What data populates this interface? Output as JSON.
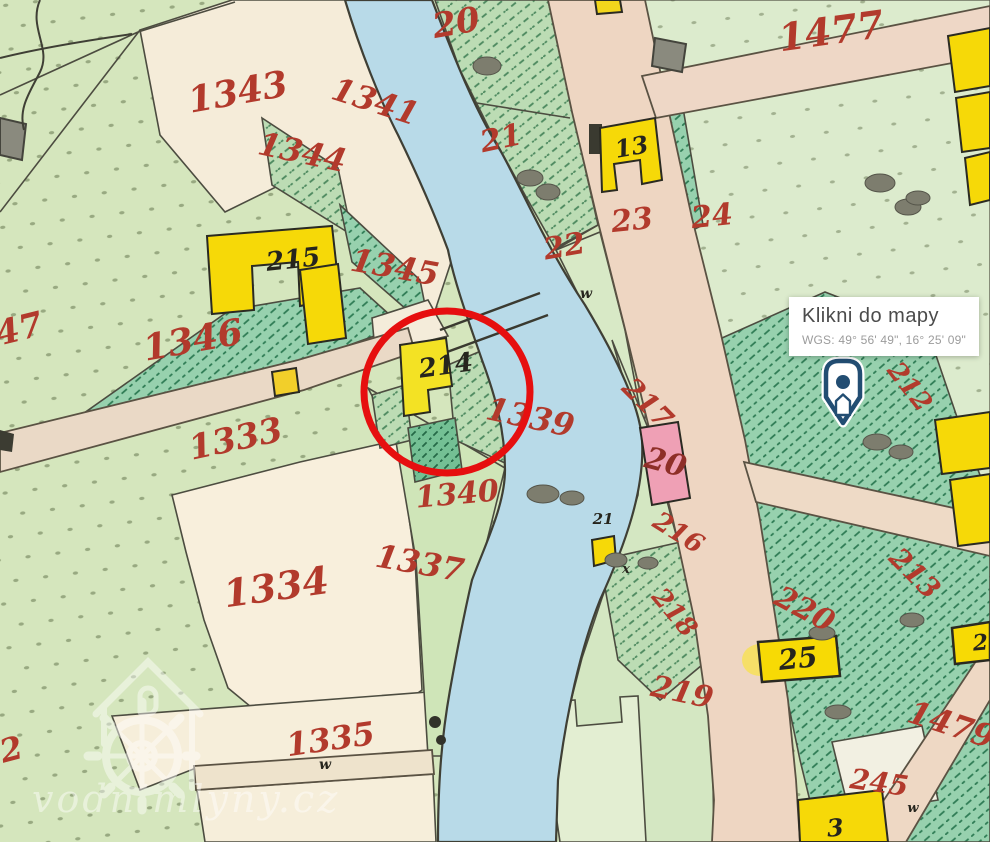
{
  "popup": {
    "title": "Klikni do mapy",
    "coords": "WGS: 49° 56' 49\", 16° 25' 09\""
  },
  "watermark": {
    "text": "vodnimlyny.cz"
  },
  "annotation": {
    "type": "highlight-circle",
    "color": "#e60f0f"
  },
  "colors": {
    "river": "#b8dae8",
    "road": "#eedac6",
    "building_yellow": "#f6d908",
    "building_pink": "#efa0b5",
    "parcel_label_red": "#b23a2c",
    "pin_navy": "#224d72"
  },
  "map": {
    "labels": [
      {
        "text": "20",
        "x": 458,
        "y": 34,
        "rot": -10,
        "size": 34,
        "color": "red"
      },
      {
        "text": "1477",
        "x": 833,
        "y": 44,
        "rot": -8,
        "size": 38,
        "color": "red"
      },
      {
        "text": "1343",
        "x": 240,
        "y": 104,
        "rot": -10,
        "size": 36,
        "color": "red"
      },
      {
        "text": "1341",
        "x": 372,
        "y": 112,
        "rot": 18,
        "size": 32,
        "color": "red"
      },
      {
        "text": "1344",
        "x": 300,
        "y": 163,
        "rot": 12,
        "size": 32,
        "color": "red"
      },
      {
        "text": "21",
        "x": 503,
        "y": 148,
        "rot": -12,
        "size": 30,
        "color": "red"
      },
      {
        "text": "23",
        "x": 633,
        "y": 230,
        "rot": -6,
        "size": 30,
        "color": "red"
      },
      {
        "text": "24",
        "x": 713,
        "y": 226,
        "rot": -6,
        "size": 30,
        "color": "red"
      },
      {
        "text": "22",
        "x": 566,
        "y": 256,
        "rot": -10,
        "size": 30,
        "color": "red"
      },
      {
        "text": "1345",
        "x": 393,
        "y": 278,
        "rot": 10,
        "size": 32,
        "color": "red"
      },
      {
        "text": "47",
        "x": 22,
        "y": 340,
        "rot": -14,
        "size": 34,
        "color": "red"
      },
      {
        "text": "1346",
        "x": 195,
        "y": 352,
        "rot": -10,
        "size": 36,
        "color": "red"
      },
      {
        "text": "1333",
        "x": 238,
        "y": 450,
        "rot": -12,
        "size": 34,
        "color": "red"
      },
      {
        "text": "1339",
        "x": 528,
        "y": 428,
        "rot": 12,
        "size": 32,
        "color": "red"
      },
      {
        "text": "217",
        "x": 641,
        "y": 410,
        "rot": 45,
        "size": 28,
        "color": "red"
      },
      {
        "text": "212",
        "x": 903,
        "y": 392,
        "rot": 52,
        "size": 26,
        "color": "red"
      },
      {
        "text": "20",
        "x": 663,
        "y": 472,
        "rot": 15,
        "size": 30,
        "color": "maroon"
      },
      {
        "text": "216",
        "x": 674,
        "y": 540,
        "rot": 32,
        "size": 26,
        "color": "red"
      },
      {
        "text": "1340",
        "x": 458,
        "y": 504,
        "rot": -5,
        "size": 30,
        "color": "red"
      },
      {
        "text": "1337",
        "x": 418,
        "y": 574,
        "rot": 10,
        "size": 32,
        "color": "red"
      },
      {
        "text": "213",
        "x": 908,
        "y": 580,
        "rot": 45,
        "size": 28,
        "color": "red"
      },
      {
        "text": "1334",
        "x": 278,
        "y": 600,
        "rot": -8,
        "size": 38,
        "color": "red"
      },
      {
        "text": "218",
        "x": 668,
        "y": 618,
        "rot": 50,
        "size": 26,
        "color": "red"
      },
      {
        "text": "220",
        "x": 800,
        "y": 618,
        "rot": 28,
        "size": 30,
        "color": "red"
      },
      {
        "text": "219",
        "x": 680,
        "y": 702,
        "rot": 12,
        "size": 30,
        "color": "red"
      },
      {
        "text": "1335",
        "x": 332,
        "y": 750,
        "rot": -8,
        "size": 32,
        "color": "red"
      },
      {
        "text": "2",
        "x": 14,
        "y": 760,
        "rot": -15,
        "size": 32,
        "color": "red"
      },
      {
        "text": "1479",
        "x": 948,
        "y": 735,
        "rot": 18,
        "size": 32,
        "color": "red"
      },
      {
        "text": "245",
        "x": 878,
        "y": 792,
        "rot": 8,
        "size": 28,
        "color": "red"
      },
      {
        "text": "215",
        "x": 294,
        "y": 268,
        "rot": -6,
        "size": 26,
        "color": "black"
      },
      {
        "text": "13",
        "x": 633,
        "y": 155,
        "rot": -10,
        "size": 24,
        "color": "black"
      },
      {
        "text": "214",
        "x": 447,
        "y": 374,
        "rot": -8,
        "size": 26,
        "color": "black"
      },
      {
        "text": "25",
        "x": 799,
        "y": 668,
        "rot": -6,
        "size": 28,
        "color": "black"
      },
      {
        "text": "3",
        "x": 836,
        "y": 836,
        "rot": -5,
        "size": 24,
        "color": "black"
      },
      {
        "text": "2",
        "x": 981,
        "y": 650,
        "rot": -5,
        "size": 22,
        "color": "black"
      },
      {
        "text": "21",
        "x": 603,
        "y": 524,
        "rot": 0,
        "size": 15,
        "color": "black"
      },
      {
        "text": "w",
        "x": 586,
        "y": 298,
        "rot": 0,
        "size": 14,
        "color": "black"
      },
      {
        "text": "w",
        "x": 325,
        "y": 769,
        "rot": 0,
        "size": 14,
        "color": "black"
      },
      {
        "text": "w",
        "x": 913,
        "y": 812,
        "rot": 0,
        "size": 13,
        "color": "black"
      },
      {
        "text": "x",
        "x": 626,
        "y": 573,
        "rot": 0,
        "size": 13,
        "color": "black"
      }
    ]
  }
}
